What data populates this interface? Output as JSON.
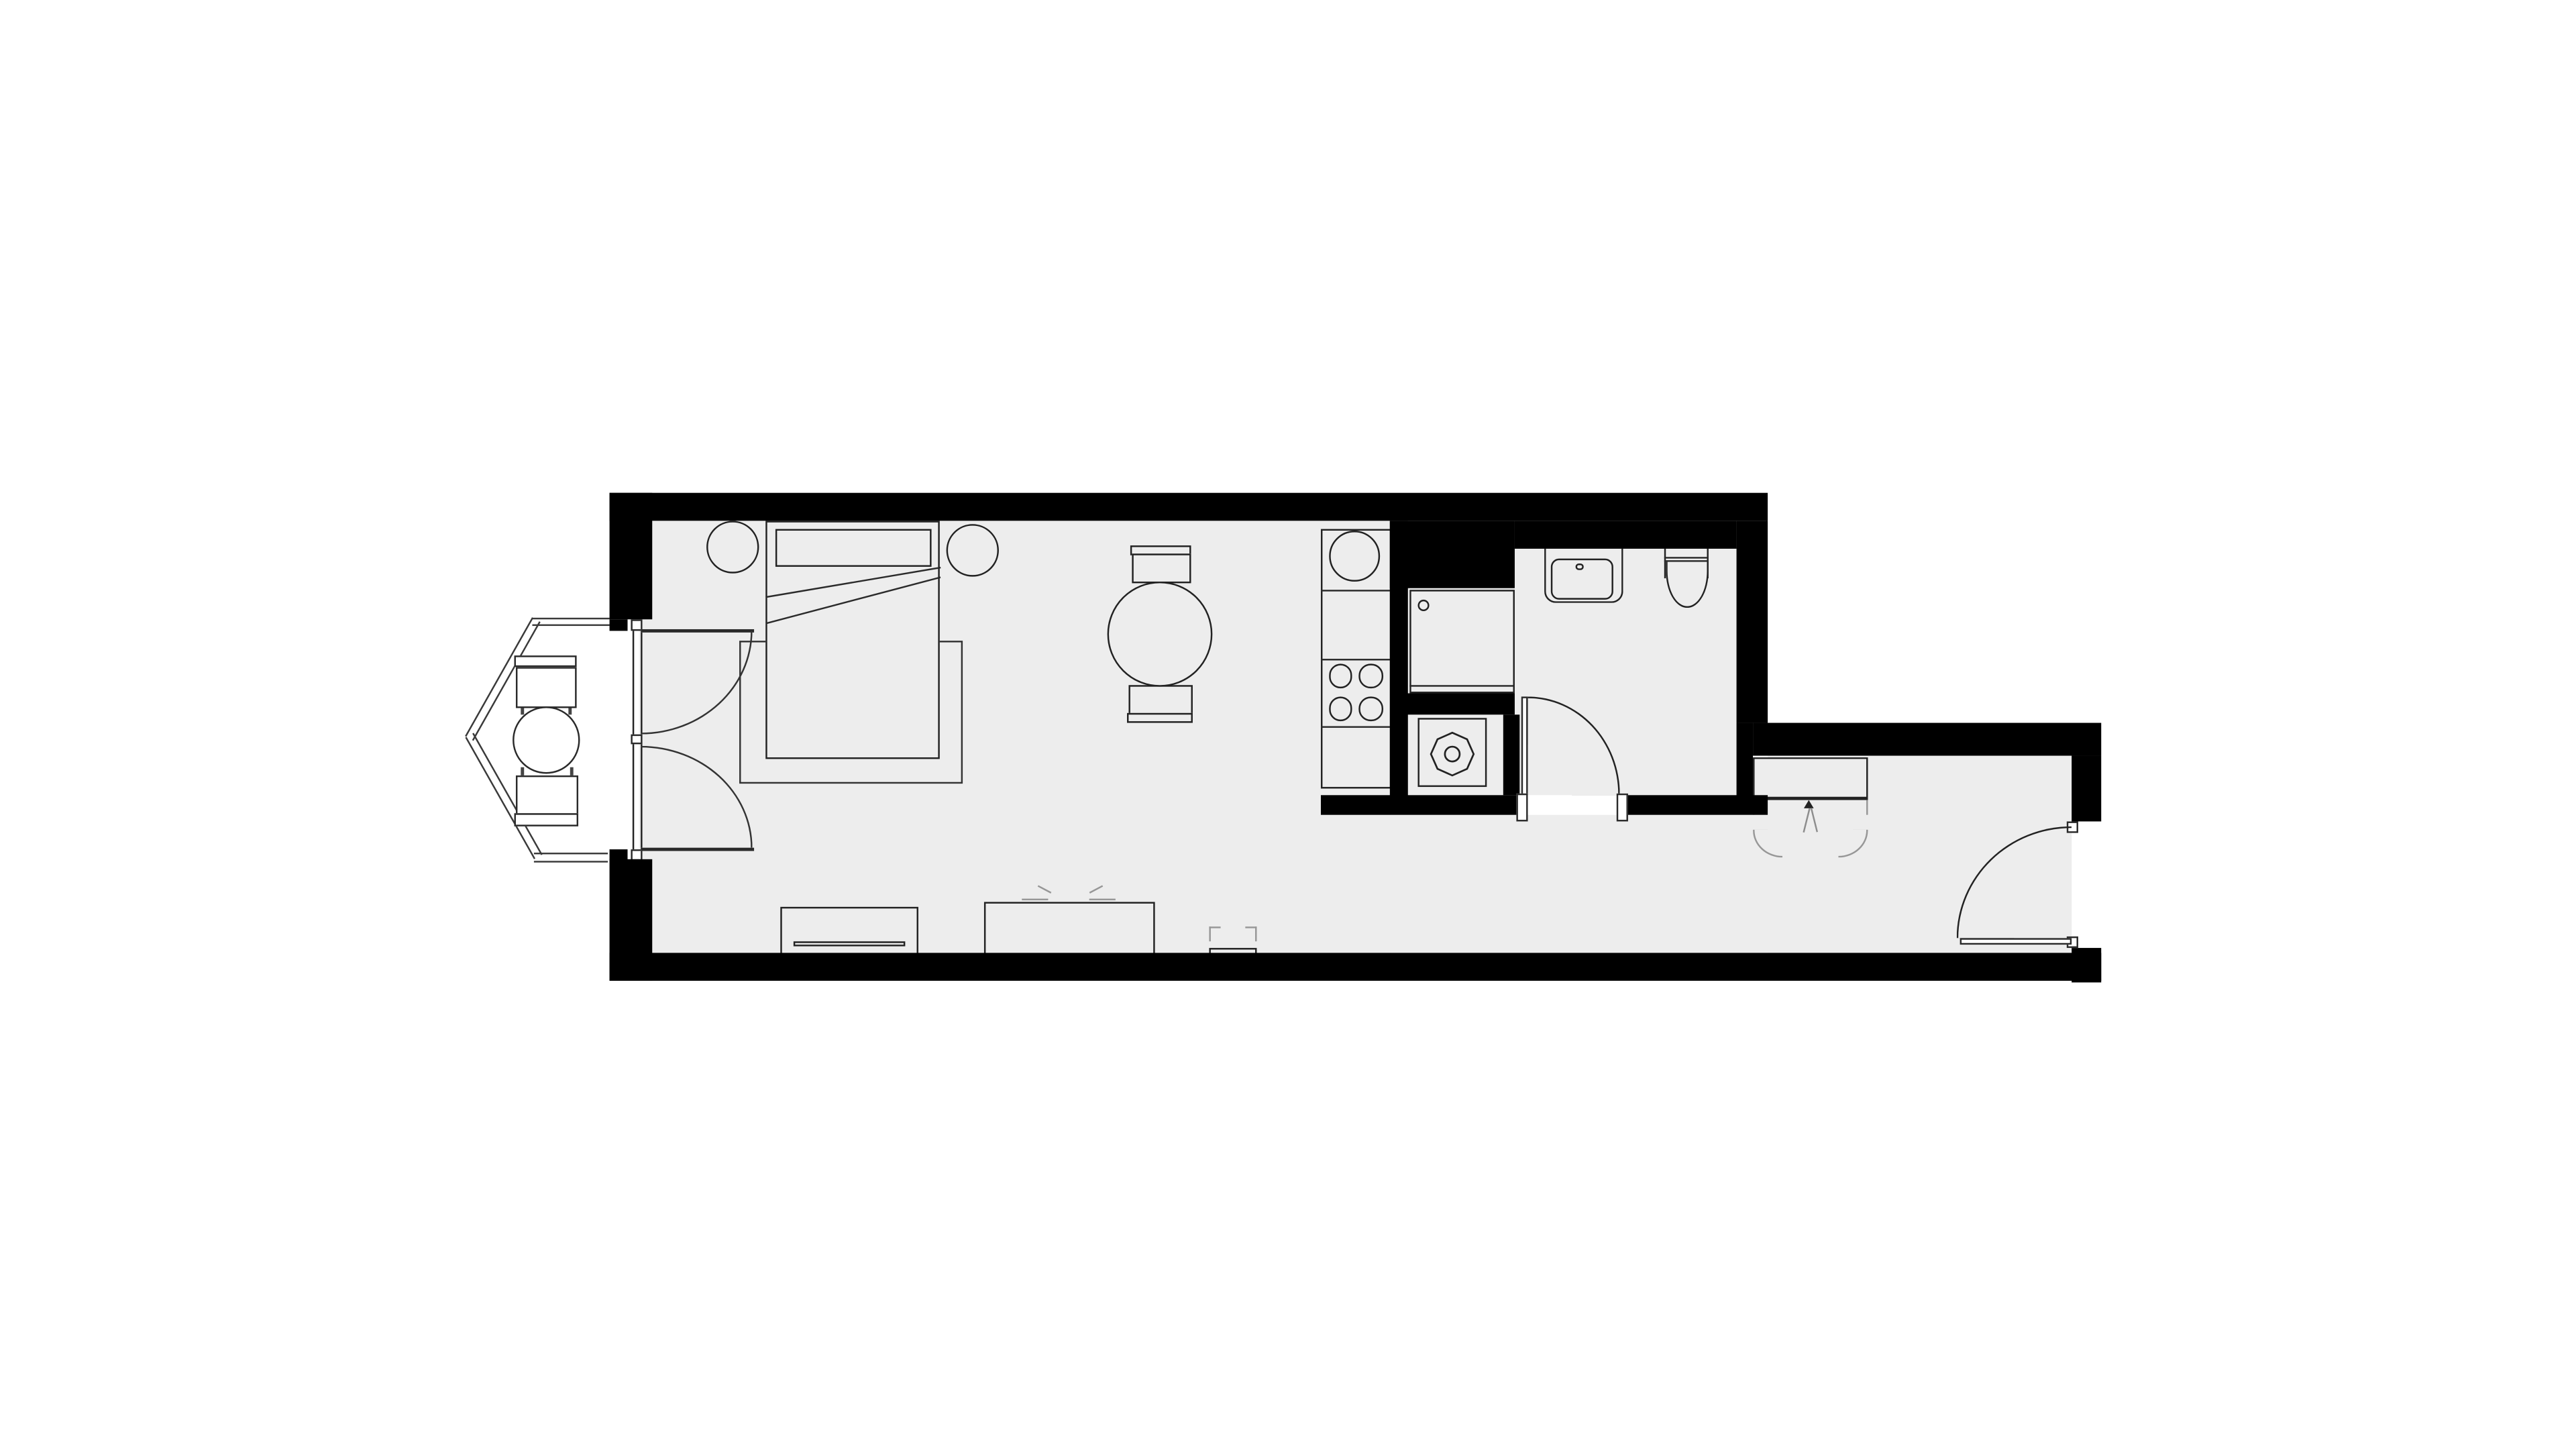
{
  "title": "Studio apartment floor plan",
  "colors": {
    "background": "#ffffff",
    "walls": "#000000",
    "floor_fill": "#ededed",
    "furniture_outline": "#222222",
    "light_symbol_lines": "#979797"
  },
  "rooms": [
    {
      "name": "living-bedroom",
      "furniture": [
        "double-bed",
        "pillow",
        "blanket-fold-lines",
        "rug",
        "bedside-table-left",
        "bedside-table-right",
        "round-dining-table",
        "dining-chair-top",
        "dining-chair-bottom",
        "sideboard-with-drawer",
        "sliding-door-wardrobe",
        "radiator"
      ]
    },
    {
      "name": "bay-balcony",
      "furniture": [
        "round-bistro-table",
        "bay-chair-upper",
        "bay-chair-lower",
        "double-french-doors",
        "window-front"
      ]
    },
    {
      "name": "kitchen",
      "furniture": [
        "counter-run",
        "round-sink-basin",
        "cooktop-4-burners"
      ]
    },
    {
      "name": "utility-niche",
      "furniture": [
        "tall-appliance-cabinet",
        "washing-machine"
      ]
    },
    {
      "name": "bathroom",
      "furniture": [
        "wash-basin",
        "toilet",
        "inward-swing-door"
      ]
    },
    {
      "name": "entrance-hall",
      "furniture": [
        "built-in-closet-with-swing-doors",
        "entry-door"
      ]
    }
  ],
  "doors": [
    {
      "name": "french-doors-to-bay",
      "type": "double-leaf",
      "swing": "into-room"
    },
    {
      "name": "bathroom-door",
      "type": "single-leaf",
      "swing": "into-bathroom"
    },
    {
      "name": "entry-door",
      "type": "single-leaf",
      "swing": "into-hall"
    }
  ],
  "legend": {
    "scale_text": "",
    "annotations": []
  }
}
